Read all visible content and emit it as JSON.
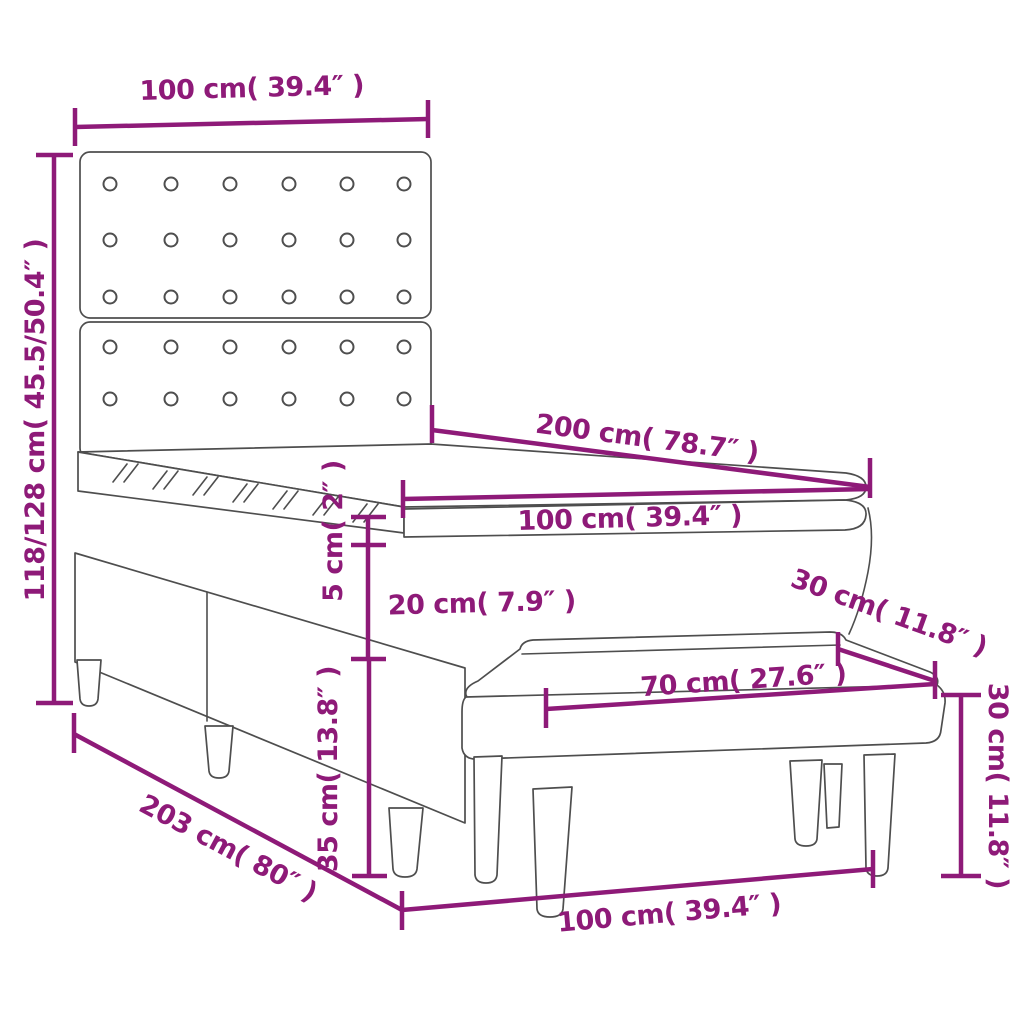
{
  "colors": {
    "dimension_annotation": "#8e1a78",
    "outline": "#4e4e4e",
    "background": "#ffffff"
  },
  "objects": {
    "main": "box-spring-bed-with-tufted-headboard",
    "top_layer": "mattress-topper",
    "front": "upholstered-bench"
  },
  "labels": {
    "headboard_width": "100 cm( 39.4″ )",
    "overall_height": "118/128 cm( 45.5/50.4″ )",
    "bed_length": "200 cm( 78.7″ )",
    "mattress_width": "100 cm( 39.4″ )",
    "topper_height": "5 cm( 2″ )",
    "mattress_height": "20 cm( 7.9″ )",
    "bench_depth": "30 cm( 11.8″ )",
    "base_height": "35 cm( 13.8″ )",
    "bench_top_length": "70 cm( 27.6″ )",
    "bench_height": "30 cm( 11.8″ )",
    "frame_length": "203 cm( 80″ )",
    "bench_overall_length": "100 cm( 39.4″ )"
  }
}
